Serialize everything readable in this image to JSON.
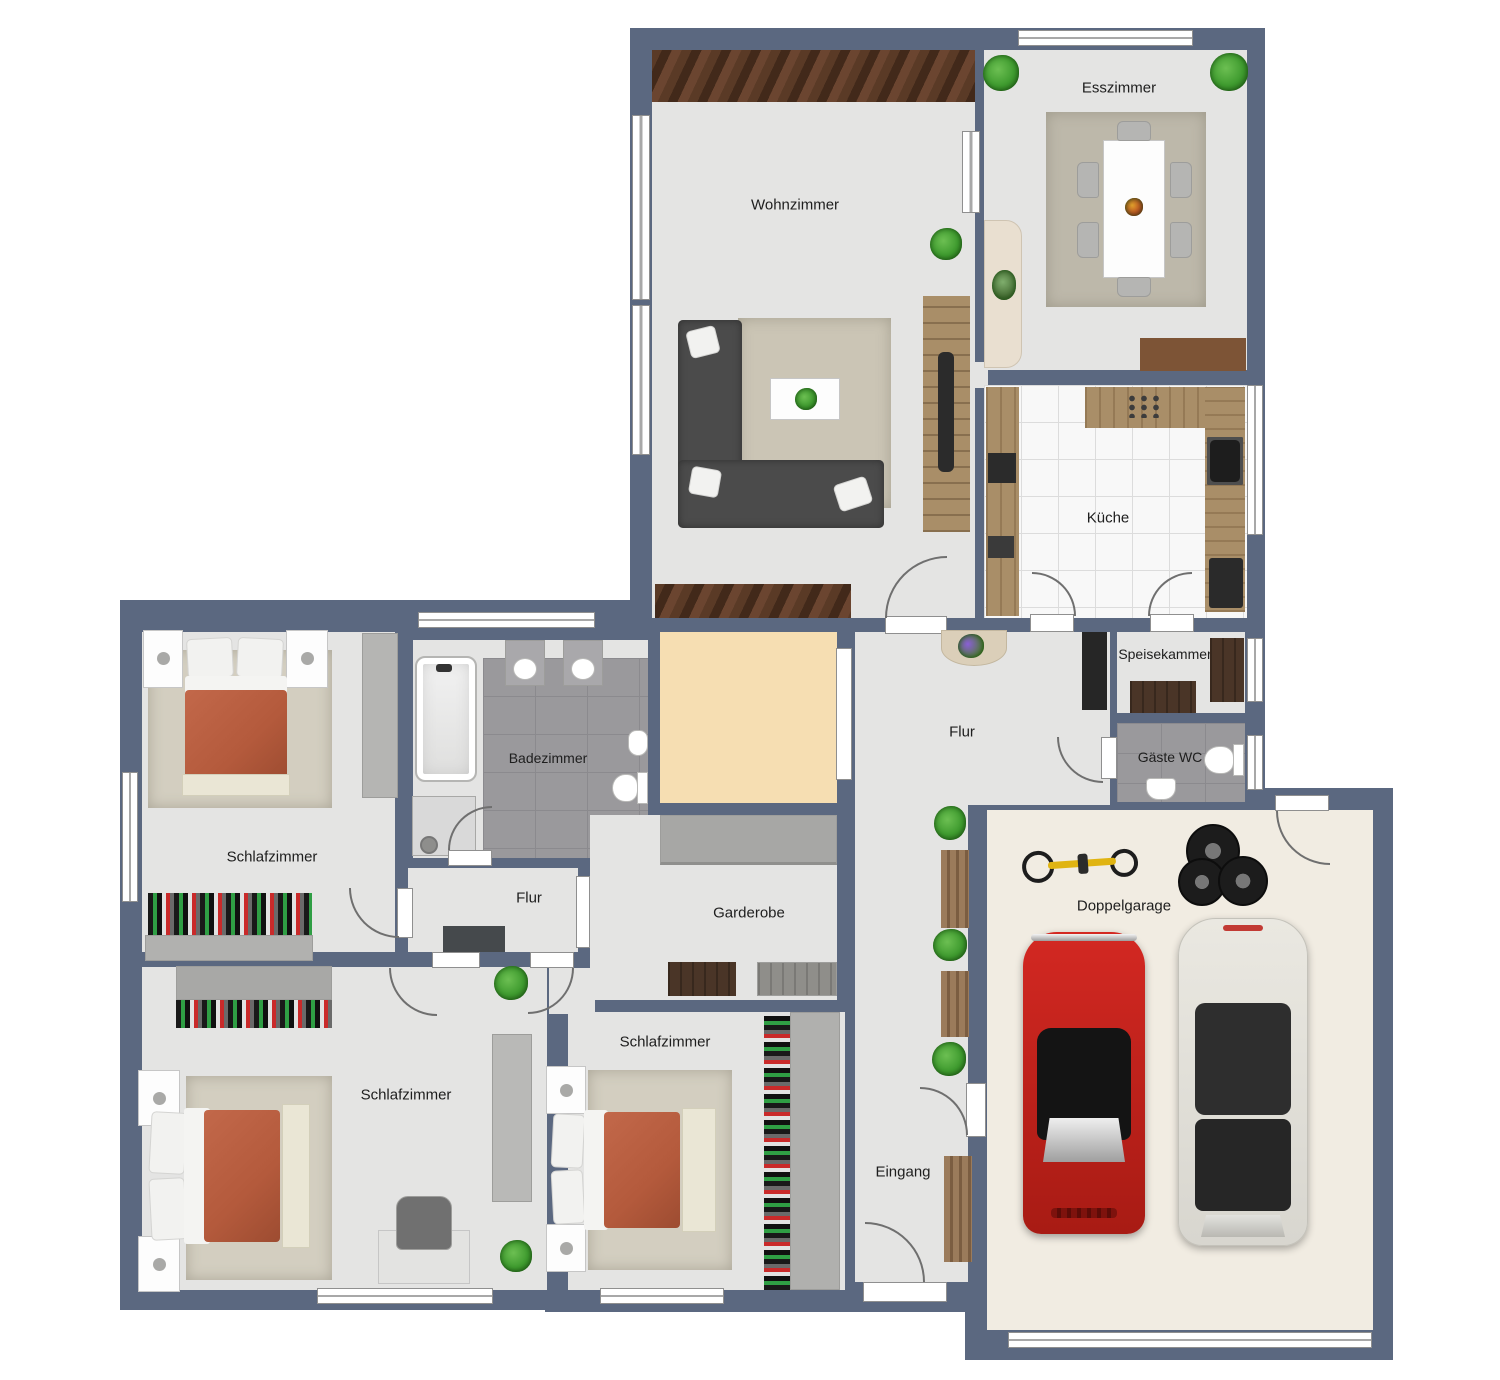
{
  "plan": {
    "title": "Wohnung Grundriss mit Doppelgarage",
    "rooms": {
      "wohnzimmer": {
        "label": "Wohnzimmer"
      },
      "esszimmer": {
        "label": "Esszimmer"
      },
      "kueche": {
        "label": "Küche"
      },
      "speisekammer": {
        "label": "Speisekammer"
      },
      "gaeste_wc": {
        "label": "Gäste WC"
      },
      "flur": {
        "label": "Flur"
      },
      "badezimmer": {
        "label": "Badezimmer"
      },
      "schlafzimmer_1": {
        "label": "Schlafzimmer"
      },
      "flur_klein": {
        "label": "Flur"
      },
      "garderobe": {
        "label": "Garderobe"
      },
      "schlafzimmer_2": {
        "label": "Schlafzimmer"
      },
      "schlafzimmer_3": {
        "label": "Schlafzimmer"
      },
      "eingang": {
        "label": "Eingang"
      },
      "doppelgarage": {
        "label": "Doppelgarage"
      }
    },
    "colors": {
      "wall": "#5b6880",
      "floor": "#e4e4e3",
      "bath_tile": "#9a999c",
      "kitchen_tile": "#f8f8f8",
      "tan_room": "#f6deb2",
      "garage_floor": "#f1ece2",
      "rug": "#cbc5b5",
      "wood": "#a98e68",
      "dark_wood": "#4a3527",
      "sofa": "#4b4b4b",
      "bed_duvet": "#b45a3c",
      "closet": "#b5b5b3",
      "car_red": "#d32822",
      "car_white": "#eae8e1",
      "plant": "#3f9b2f"
    }
  }
}
